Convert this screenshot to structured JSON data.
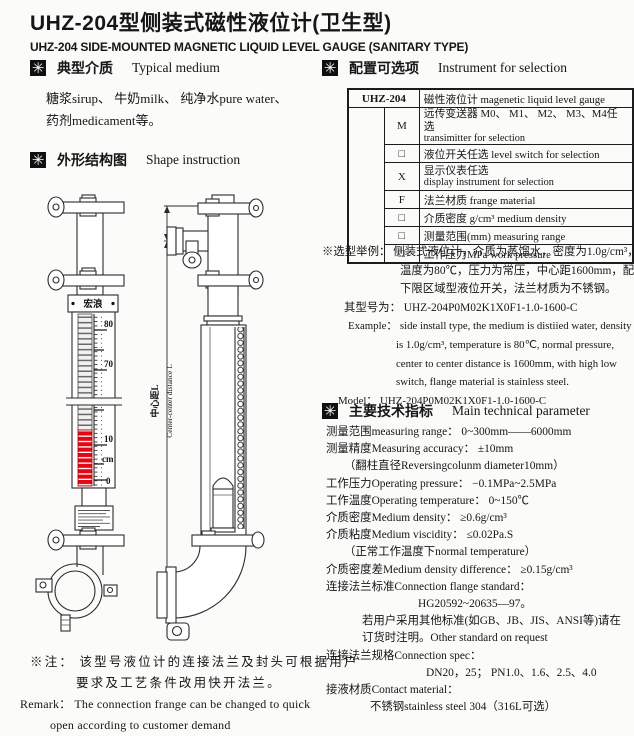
{
  "icons": {
    "section_marker": "✳"
  },
  "header": {
    "title_cn": "UHZ-204型侧装式磁性液位计(卫生型)",
    "title_en": "UHZ-204 SIDE-MOUNTED MAGNETIC LIQUID LEVEL GAUGE (SANITARY TYPE)"
  },
  "sections": {
    "medium": {
      "cn": "典型介质",
      "en": "Typical medium"
    },
    "shape": {
      "cn": "外形结构图",
      "en": "Shape  instruction"
    },
    "selection": {
      "cn": "配置可选项",
      "en": "Instrument for selection"
    },
    "parameters": {
      "cn": "主要技术指标",
      "en": "Main technical parameter"
    }
  },
  "medium_body": {
    "line1": "糖浆sirup、 牛奶milk、 纯净水pure water、",
    "line2": "药剂medicament等。"
  },
  "selection_table": {
    "model": "UHZ-204",
    "model_desc": "磁性液位计  magenetic liquid level gauge",
    "rows": [
      {
        "code": "M",
        "line1": "远传变送器 M0、 M1、 M2、 M3、M4任选",
        "line2": "transimitter for selection"
      },
      {
        "code": "□",
        "line1": "液位开关任选 level switch for selection",
        "line2": ""
      },
      {
        "code": "X",
        "line1": "显示仪表任选",
        "line2": "display instrument for selection"
      },
      {
        "code": "F",
        "line1": "法兰材质  frange material",
        "line2": ""
      },
      {
        "code": "□",
        "line1": "介质密度 g/cm³ medium density",
        "line2": ""
      },
      {
        "code": "□",
        "line1": "测量范围(mm)  measuring range",
        "line2": ""
      },
      {
        "code": "□",
        "line1": "工作压力MPa   work pressure",
        "line2": ""
      }
    ]
  },
  "example": {
    "lines": [
      "※选型举例： 侧装式液位计，介质为蒸馏水，密度为1.0g/cm³，",
      "温度为80℃，压力为常压，中心距1600mm，配上",
      "下限区域型液位开关，法兰材质为不锈钢。",
      "其型号为： UHZ-204P0M02K1X0F1-1.0-1600-C",
      "Example： side install type, the medium is distiied water, density",
      "is 1.0g/cm³, temperature is 80℃, normal pressure,",
      "center to center distance is 1600mm, with high low",
      "switch, flange material is stainless steel.",
      "Model： UHZ-204P0M02K1X0F1-1.0-1600-C"
    ]
  },
  "tech_params": {
    "lines": [
      "测量范围measuring range： 0~300mm——6000mm",
      "测量精度Measuring accuracy： ±10mm",
      "（翻柱直径Reversingcolunm diameter10mm）",
      "工作压力Operating pressure： −0.1MPa~2.5MPa",
      "工作温度Operating temperature： 0~150℃",
      "介质密度Medium density： ≥0.6g/cm³",
      "介质粘度Medium viscidity： ≤0.02Pa.S",
      "（正常工作温度下normal temperature）",
      "介质密度差Medium density difference： ≥0.15g/cm³",
      "连接法兰标准Connection flange standard：",
      "HG20592~20635—97。",
      "若用户采用其他标准(如GB、JB、JIS、ANSI等)请在",
      "订货时注明。Other standard on request",
      "连接法兰规格Connection spec：",
      "DN20，25； PN1.0、1.6、2.5、4.0",
      "接液材质Contact material：",
      "不锈钢stainless steel 304（316L可选）"
    ]
  },
  "note": {
    "lines": [
      "※注： 该型号液位计的连接法兰及封头可根据用户",
      "要求及工艺条件改用快开法兰。",
      "Remark： The connection frange can be changed to quick",
      "open according to customer demand"
    ]
  },
  "drawing": {
    "scale_80": "80",
    "scale_70": "70",
    "scale_10": "10",
    "scale_cm": "cm",
    "scale_0": "0",
    "brand": "宏浪",
    "dim_cn": "中心距L",
    "dim_en": "Center-center distance L",
    "red_color": "#e30613"
  }
}
